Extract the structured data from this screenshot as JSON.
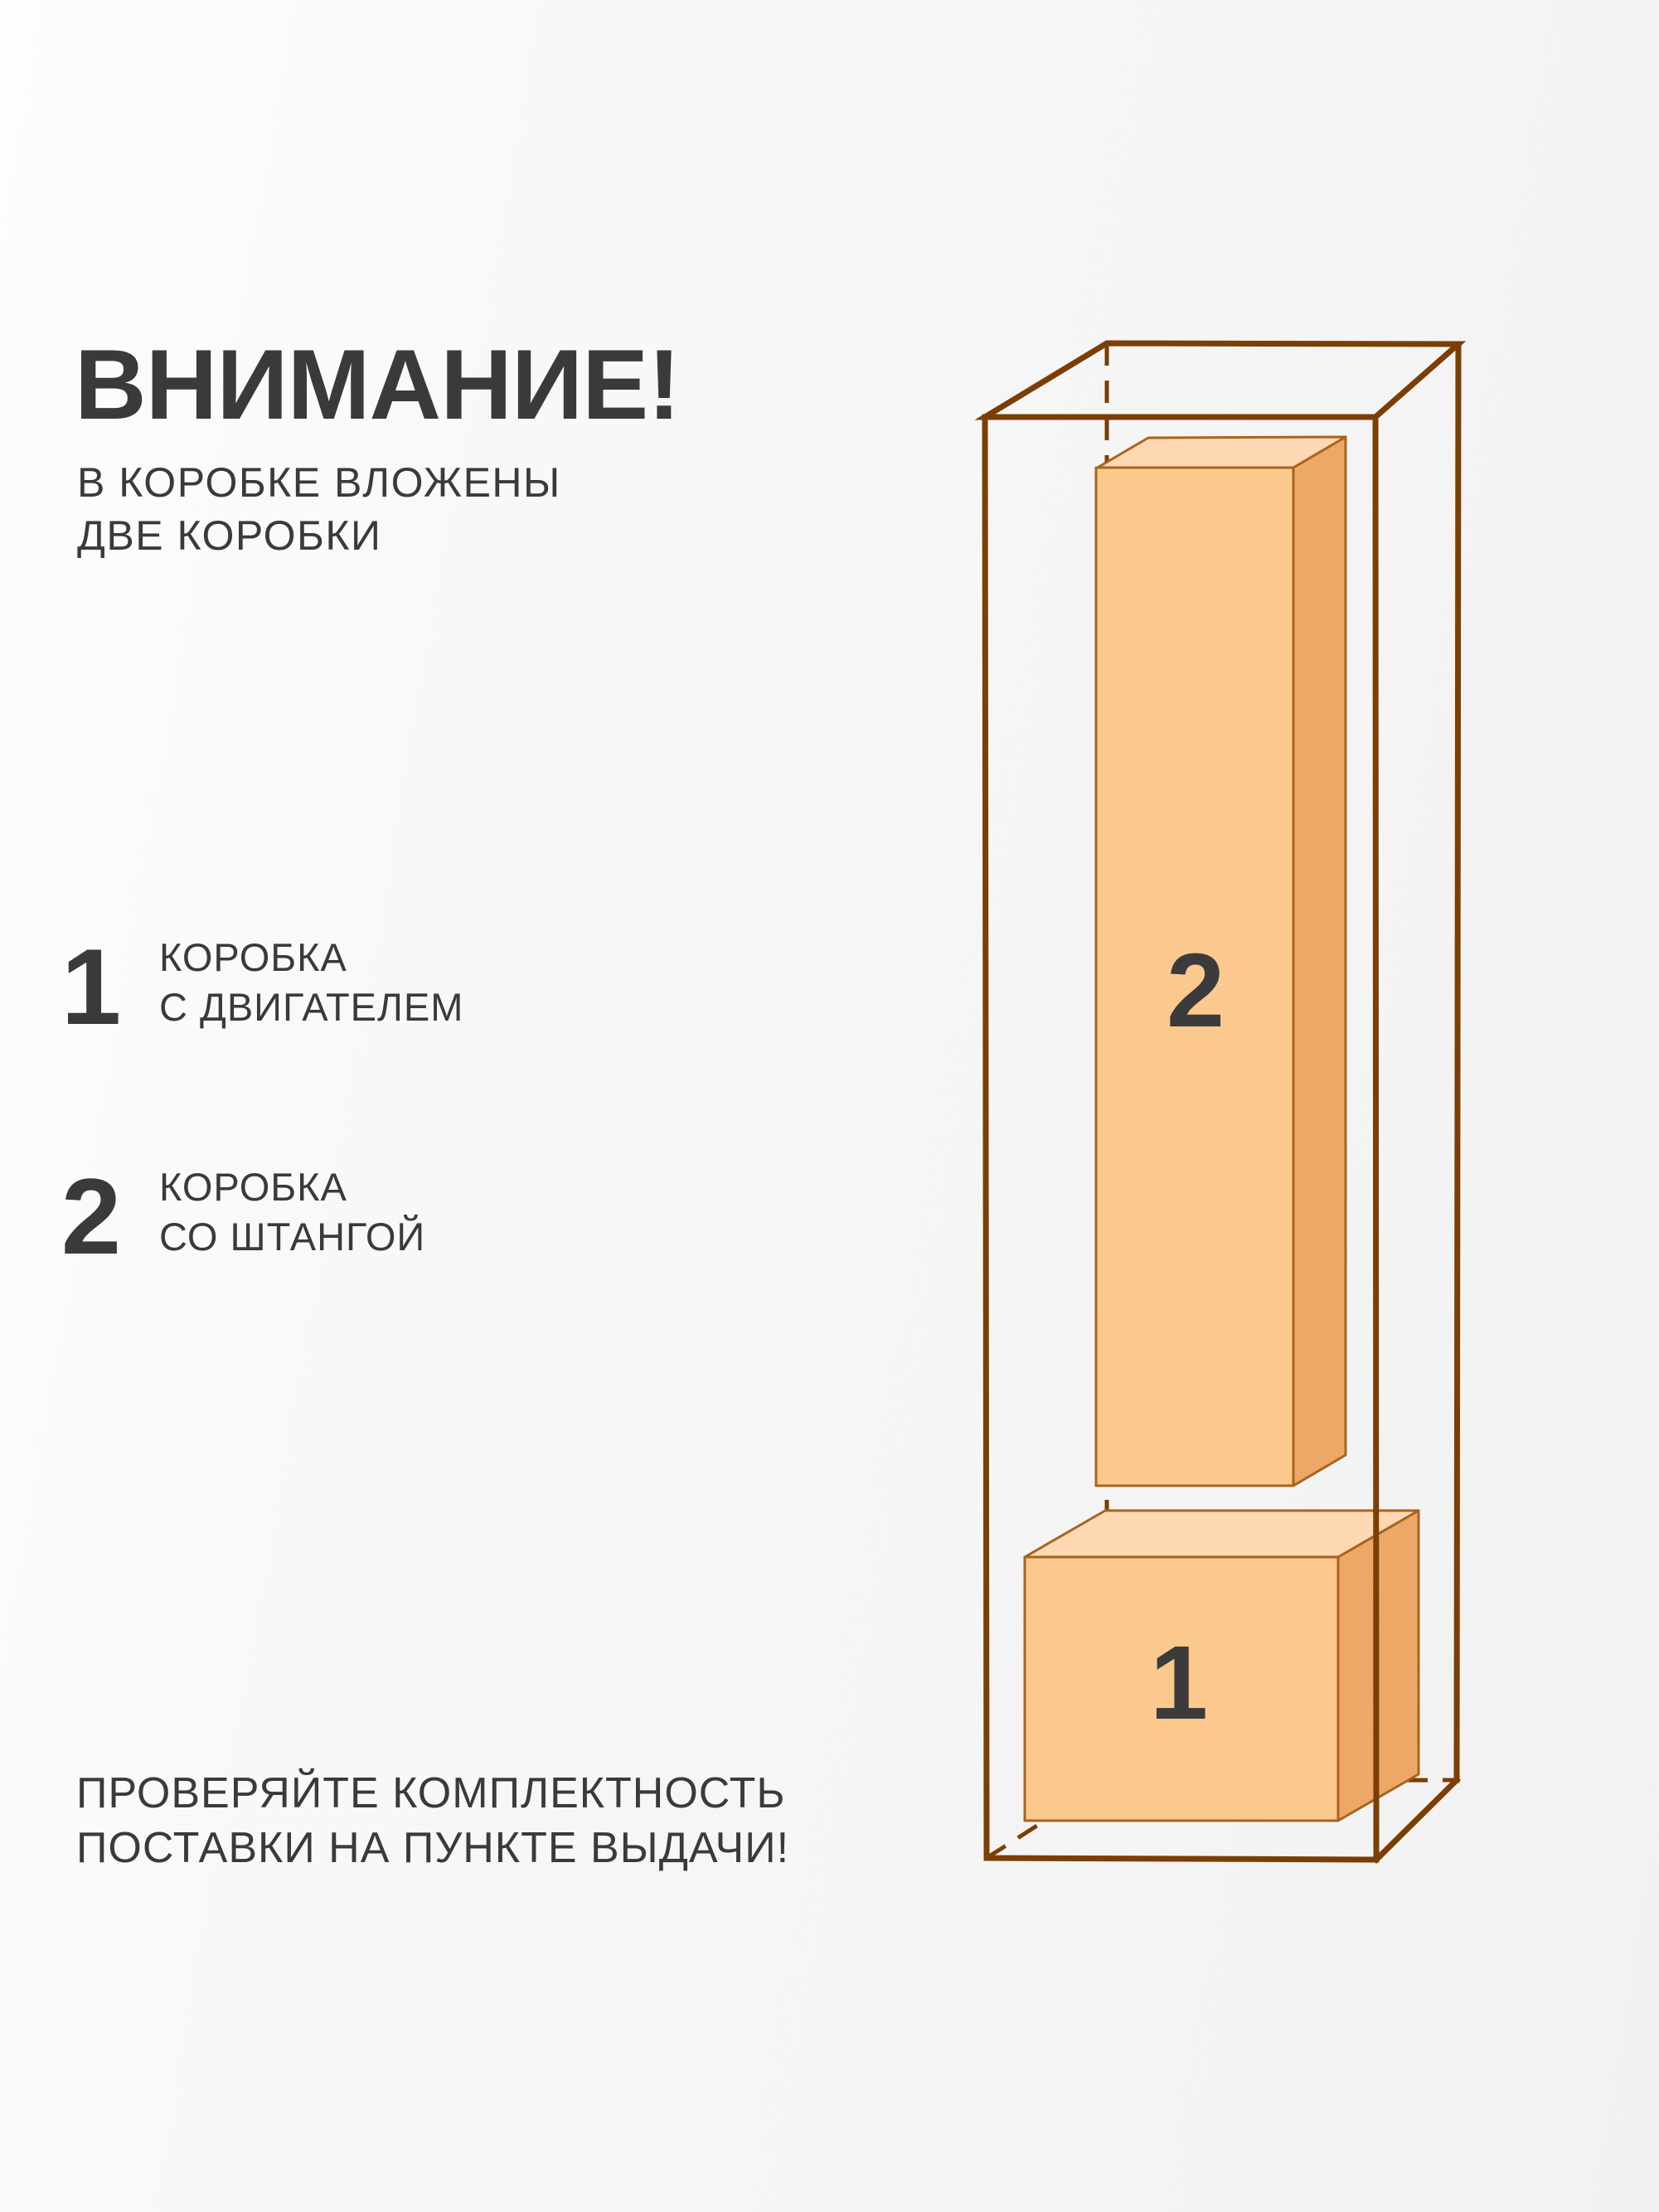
{
  "header": {
    "title": "ВНИМАНИЕ!",
    "subtitle_line1": "В КОРОБКЕ ВЛОЖЕНЫ",
    "subtitle_line2": "ДВЕ КОРОБКИ"
  },
  "items": [
    {
      "number": "1",
      "label_line1": "КОРОБКА",
      "label_line2": "С ДВИГАТЕЛЕМ"
    },
    {
      "number": "2",
      "label_line1": "КОРОБКА",
      "label_line2": "СО ШТАНГОЙ"
    }
  ],
  "footer": {
    "line1": "ПРОВЕРЯЙТЕ КОМПЛЕКТНОСТЬ",
    "line2": "ПОСТАВКИ НА ПУНКТЕ ВЫДАЧИ!"
  },
  "diagram": {
    "box1": {
      "label": "1"
    },
    "box2": {
      "label": "2"
    },
    "colors": {
      "wireframe": "#7b3e04",
      "box_outline": "#a8641e",
      "face_front": "#fbc98e",
      "face_top": "#fdd8b2",
      "face_side": "#eda868",
      "box_label": "#3b3b3b",
      "text": "#3a3a3a"
    }
  }
}
